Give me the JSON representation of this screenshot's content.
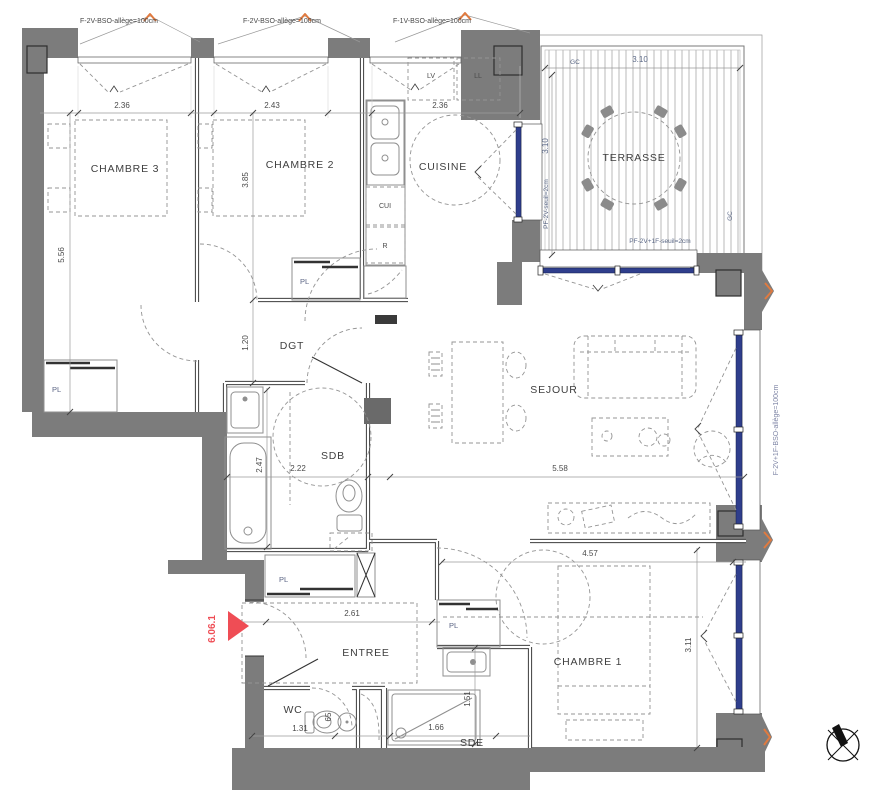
{
  "plan": {
    "lot_marker": "6.06.1",
    "rooms": {
      "chambre1": "CHAMBRE 1",
      "chambre2": "CHAMBRE 2",
      "chambre3": "CHAMBRE 3",
      "cuisine": "CUISINE",
      "sejour": "SEJOUR",
      "terrasse": "TERRASSE",
      "sdb": "SDB",
      "sde": "SDE",
      "wc": "WC",
      "entree": "ENTREE",
      "dgt": "DGT"
    },
    "closet_label": "PL",
    "appliances": {
      "dishwasher": "LV",
      "washer": "LL",
      "stove": "CUI",
      "fridge": "R"
    },
    "dimensions": {
      "chambre3_width": "2.36",
      "chambre2_width": "2.43",
      "cuisine_width": "2.36",
      "chambre3_height": "5.56",
      "chambre2_height": "3.85",
      "dgt_height": "1.20",
      "sdb_height": "2.47",
      "sdb_width": "2.22",
      "sejour_width": "5.58",
      "chambre1_width": "4.57",
      "chambre1_height": "3.11",
      "entree_width": "2.61",
      "sde_height": "1.51",
      "wc_width": "1.31",
      "sde_width": "1.66",
      "terrasse_width": "3.10",
      "terrasse_height": "3.10",
      "wc_door_width": "65"
    },
    "window_labels": {
      "top_left": "F-2V-BSO-allège=100cm",
      "top_middle": "F-2V-BSO-allège=100cm",
      "top_right": "F-1V-BSO-allège=100cm",
      "right_side": "F-2V+1F-BSO-allège=100cm",
      "terrasse_door": "PF-2V-seuil=2cm",
      "terrasse_bay": "PF-2V+1F-seuil=2cm"
    },
    "guardrail_label": "GC",
    "colors": {
      "wall_gray": "#7c7c7c",
      "window_blue": "#2f3e8c",
      "marker_red": "#ef4d55",
      "accent_orange": "#e07a3f"
    }
  }
}
